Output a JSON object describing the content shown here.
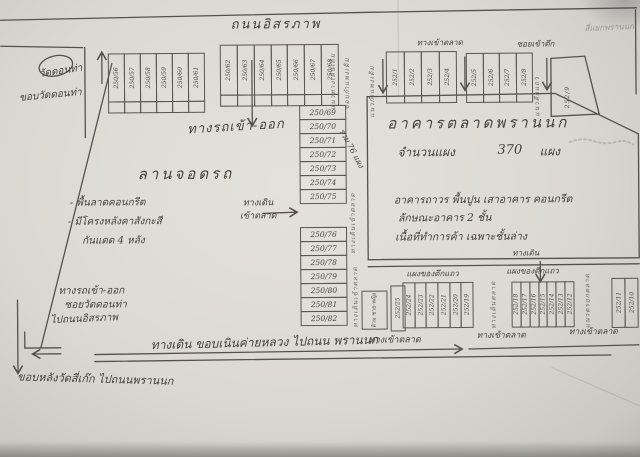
{
  "top": {
    "road": "ถนนอิสรภาพ",
    "corner_note": "สี่แยกพรานนก"
  },
  "left": {
    "temple": "วัดดอนท่า",
    "temple_edge": "ขอบวัดดอนท่า",
    "exit1": "ทางรถเข้า-ออก",
    "exit2": "ซอยวัดดอนท่า",
    "exit3": "ไปถนนอิสรภาพ",
    "back_edge": "ขอบหลังวัดสี่เก๊ก ไปถนนพรานนก"
  },
  "parking": {
    "title": "ลานจอดรถ",
    "note1": "- พื้นลาดคอนกรีต",
    "note2": "- มีโครงหลังคาสังกะสี",
    "note3": "กันแดด 4 หลัง"
  },
  "center": {
    "gate": "ทางรถเข้า-ออก",
    "walk1": "ทางเดิน",
    "walk2": "เข้าตลาด",
    "total": "รวม 76 แผง",
    "v1": "แนวทางเดินเดิม",
    "v2": "ขอบกำแพงเดิม",
    "v3": "ทางเดินเข้าตลาด",
    "v4": "ทางเดินเข้าตลาด"
  },
  "market": {
    "title": "อาคารตลาดพรานนก",
    "count_label": "จำนวนแผง",
    "count_value": "370",
    "count_unit": "แผง",
    "desc1": "อาคารถาวร พื้นปูน เสาอาคาร คอนกรีต",
    "desc2": "ลักษณะอาคาร 2 ชั้น",
    "desc3": "เนื้อที่ทำการค้า เฉพาะชั้นล่าง",
    "entry_top": "ทางเข้าตลาด",
    "soi_top": "ซอยเข้าตึก",
    "wall_left": "แนวกำแพงเดิม",
    "row_wall": "แนวตึกแถว"
  },
  "bottom": {
    "row_left": "แผงของตึกแถว",
    "row_right": "แผงของตึกแถว",
    "walk": "ทางเดิน",
    "entry1": "ทางเข้าตลาด",
    "entry2": "ทางเข้าตลาด",
    "entry3": "ทางเข้าตลาด",
    "toilet": "ส้วม ชาย-หญิง",
    "walkway": "ทางเดิน ขอบเนินค่ายหลวง ไปถนน พรานนก",
    "lane1": "ทางเดินตลาด",
    "lane2": "แนวตรอกตลาด"
  },
  "stalls": {
    "blocks": [
      {
        "id": "top-left",
        "orient": "v",
        "empty_row": true,
        "numbers": [
          "250/56",
          "250/57",
          "250/58",
          "250/59",
          "250/60",
          "250/61"
        ]
      },
      {
        "id": "top-center",
        "orient": "v",
        "empty_row": true,
        "numbers": [
          "250/62",
          "250/63",
          "250/64",
          "250/65",
          "250/66",
          "250/67",
          "250/68"
        ]
      },
      {
        "id": "col-upper",
        "orient": "h",
        "numbers": [
          "250/69",
          "250/70",
          "250/71",
          "250/72",
          "250/73",
          "250/74",
          "250/75"
        ]
      },
      {
        "id": "col-lower",
        "orient": "h",
        "numbers": [
          "250/76",
          "250/77",
          "250/78",
          "250/79",
          "250/80",
          "250/81",
          "250/82"
        ]
      },
      {
        "id": "tr-1",
        "orient": "v",
        "numbers": [
          "252/1",
          "252/2",
          "252/3",
          "252/4"
        ]
      },
      {
        "id": "tr-2",
        "orient": "v",
        "numbers": [
          "252/5",
          "252/6",
          "252/7",
          "252/8"
        ]
      },
      {
        "id": "bottom-single",
        "orient": "v",
        "numbers": [
          "252/25"
        ]
      },
      {
        "id": "bottom-left",
        "orient": "v",
        "numbers": [
          "252/24",
          "252/23",
          "252/22",
          "252/21",
          "252/20",
          "252/19"
        ]
      },
      {
        "id": "bottom-right",
        "orient": "v",
        "numbers": [
          "252/18",
          "252/17",
          "252/16",
          "252/15",
          "252/14",
          "252/13",
          "252/12"
        ]
      },
      {
        "id": "bottom-far",
        "orient": "v",
        "numbers": [
          "252/11",
          "252/10"
        ]
      }
    ],
    "trapezoid_number": "252/9"
  }
}
